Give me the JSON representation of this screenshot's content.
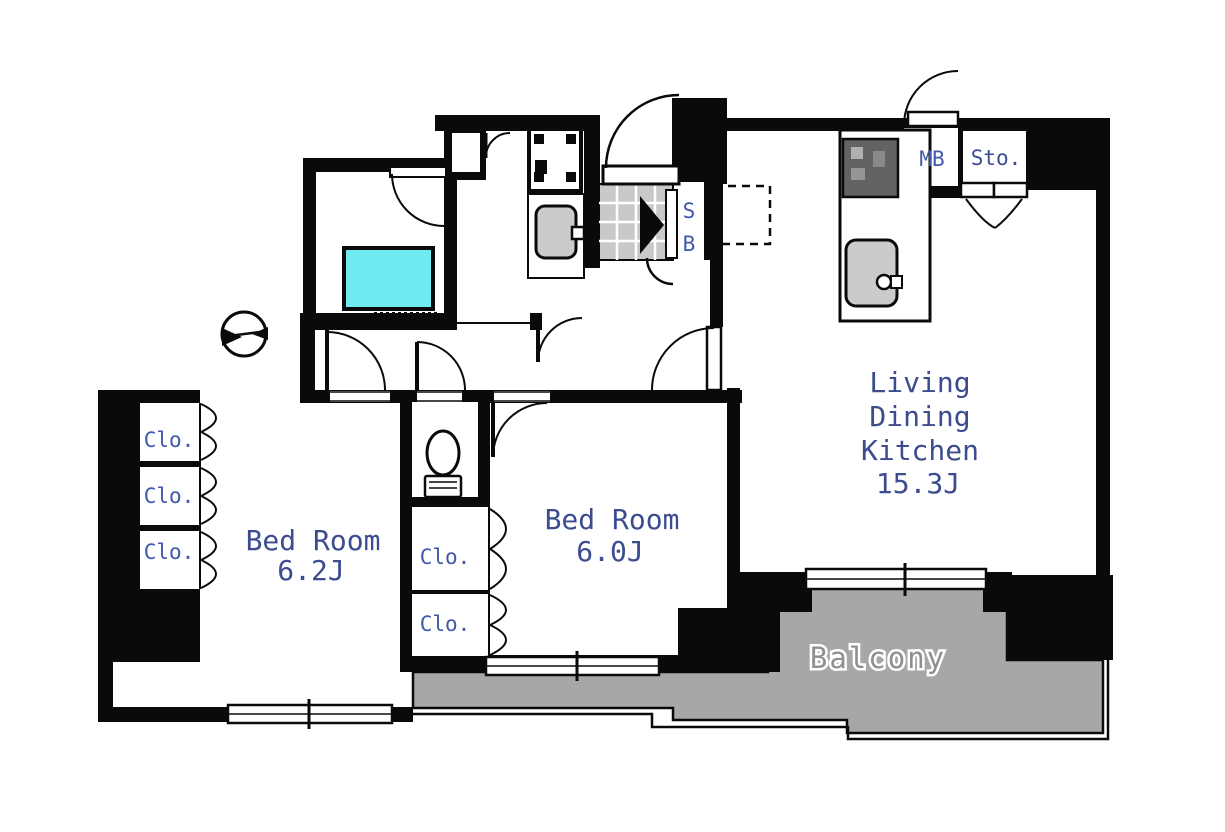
{
  "rooms": {
    "ldk": {
      "line1": "Living",
      "line2": "Dining",
      "line3": "Kitchen",
      "size": "15.3J"
    },
    "bedroom1": {
      "name": "Bed Room",
      "size": "6.2J"
    },
    "bedroom2": {
      "name": "Bed Room",
      "size": "6.0J"
    },
    "balcony": {
      "name": "Balcony"
    }
  },
  "labels": {
    "closet": "Clo.",
    "meter_box": "MB",
    "storage": "Sto.",
    "shoe_box_line1": "S",
    "shoe_box_line2": "B"
  },
  "colors": {
    "wall": "#0a0a0a",
    "bathtub": "#6fe9f2",
    "balcony": "#a7a7a7",
    "tile": "#c9c9c9",
    "fixture": "#cbcbcb",
    "stove": "#636363",
    "room_text": "#3c4c8e",
    "closet_text": "#4059a8",
    "balcony_text": "#8f8f8f"
  }
}
